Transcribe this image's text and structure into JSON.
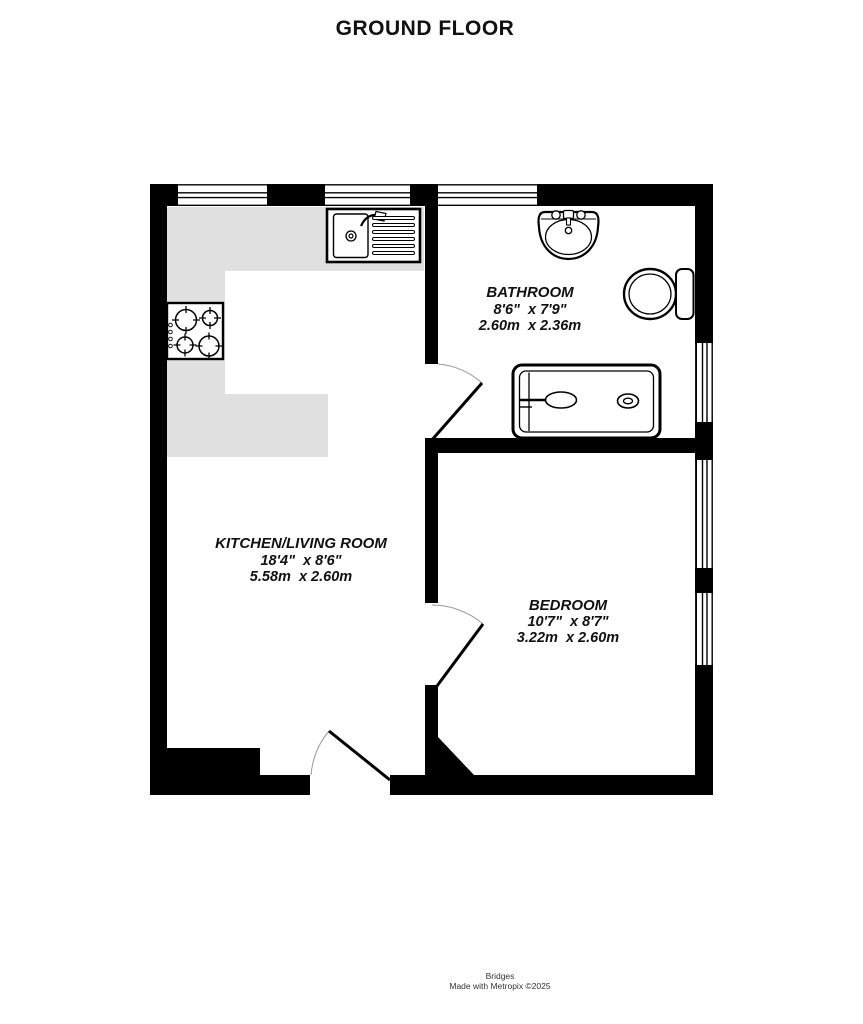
{
  "page": {
    "title": "GROUND FLOOR",
    "footer": {
      "line1": "Bridges",
      "line2": "Made with Metropix ©2025"
    }
  },
  "floorplan": {
    "colors": {
      "wall": "#000000",
      "counter": "#e0e0e0",
      "door_arc": "#9a9a9a",
      "room_fill": "#ffffff"
    },
    "rooms": [
      {
        "id": "kitchen-living-room",
        "name": "KITCHEN/LIVING ROOM",
        "size_imperial": "18'4\"  x 8'6\"",
        "size_metric": "5.58m  x 2.60m"
      },
      {
        "id": "bathroom",
        "name": "BATHROOM",
        "size_imperial": "8'6\"  x 7'9\"",
        "size_metric": "2.60m  x 2.36m"
      },
      {
        "id": "bedroom",
        "name": "BEDROOM",
        "size_imperial": "10'7\"  x 8'7\"",
        "size_metric": "3.22m  x 2.60m"
      }
    ],
    "fixtures": [
      "kitchen-sink-icon",
      "hob-icon",
      "basin-icon",
      "toilet-icon",
      "bathtub-icon"
    ],
    "doors": [
      "entrance-door",
      "bathroom-door",
      "bedroom-door"
    ]
  }
}
